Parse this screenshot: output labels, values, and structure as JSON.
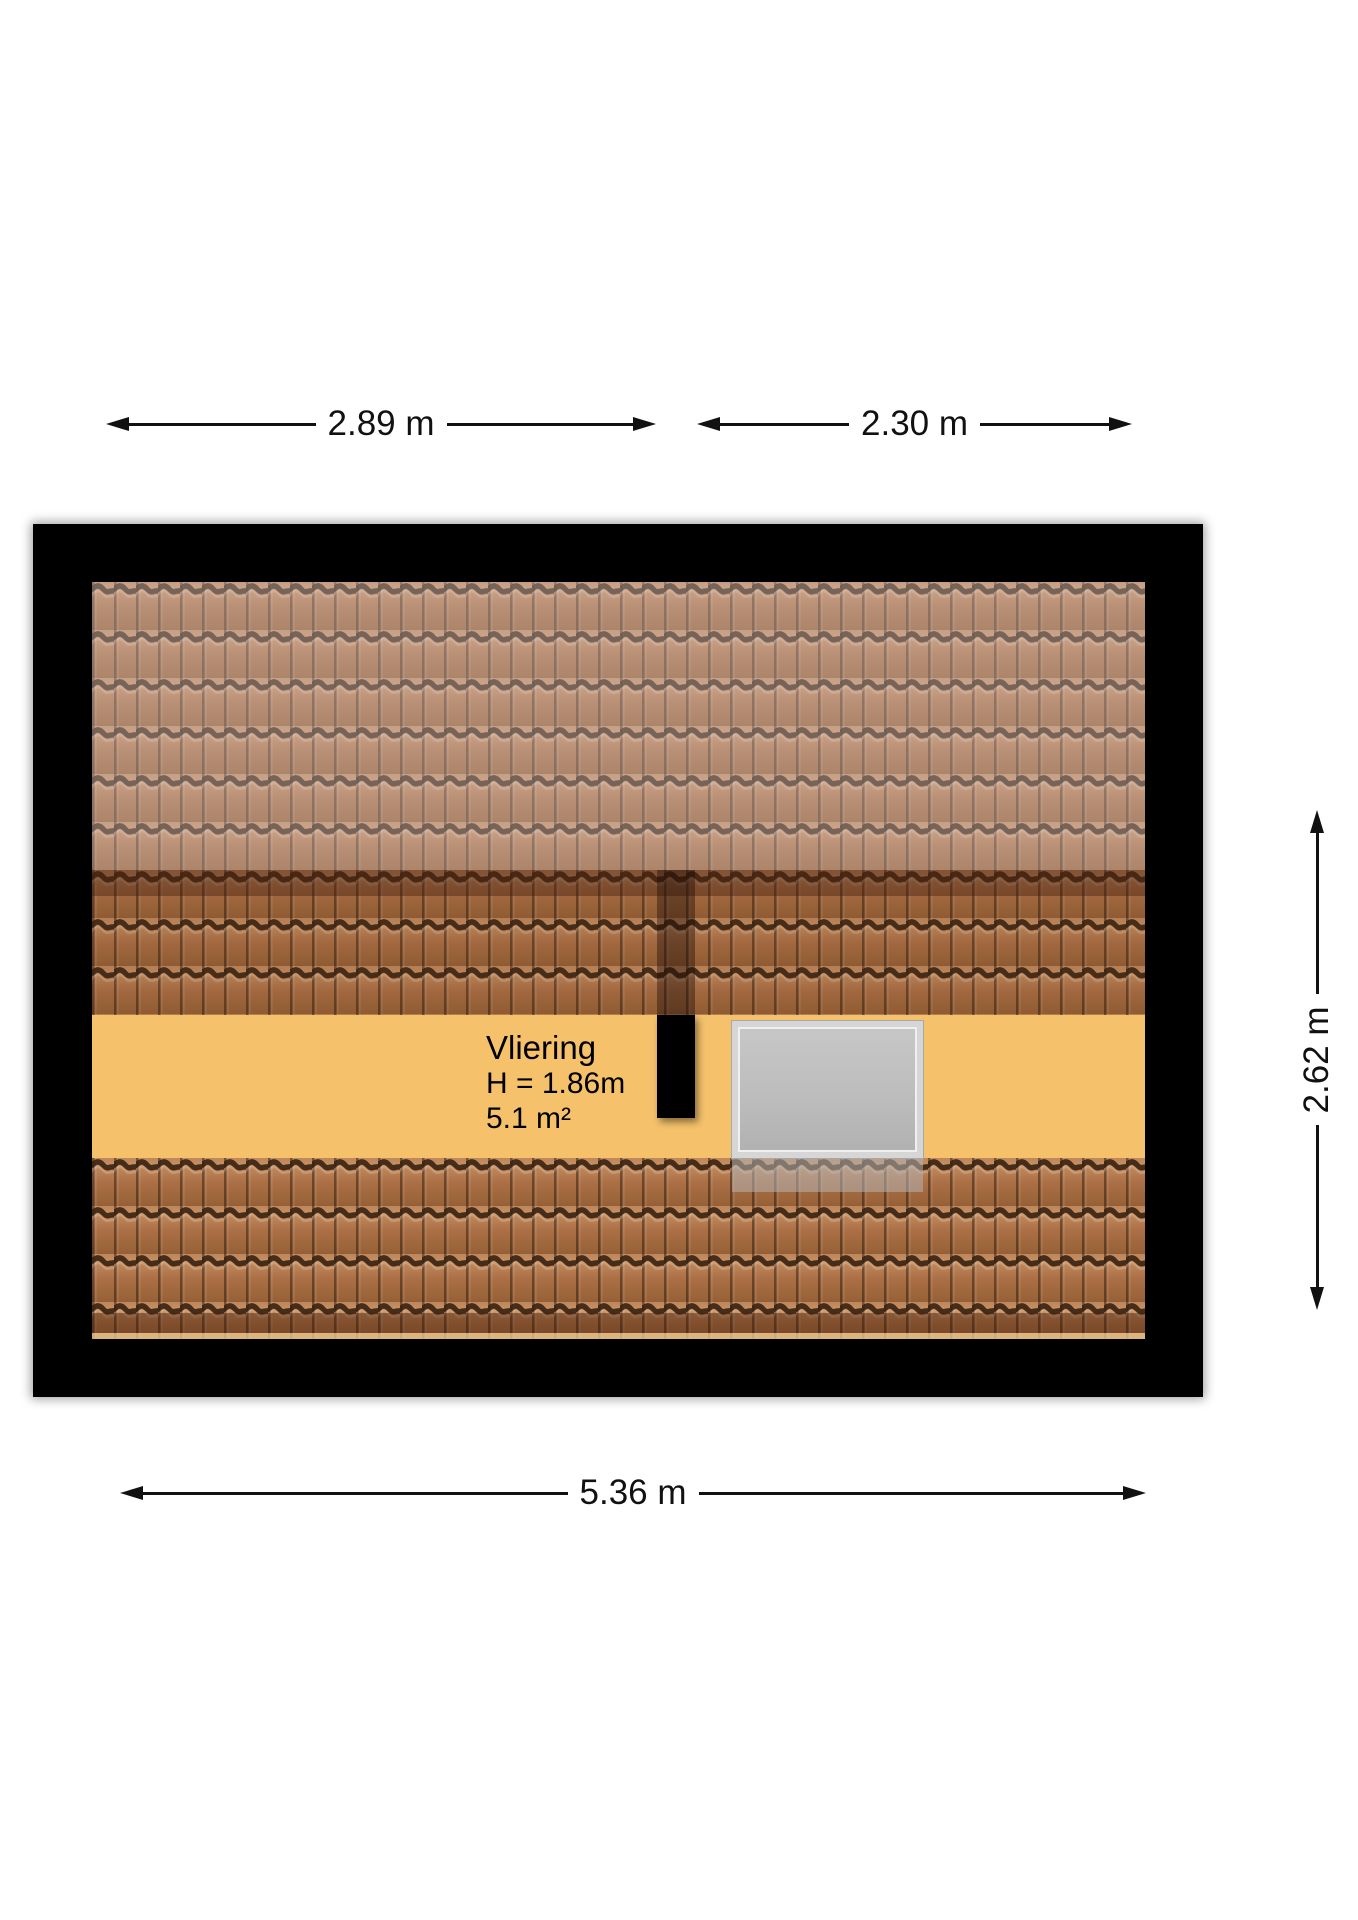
{
  "plan": {
    "type": "attic-floorplan",
    "room": {
      "name": "Vliering",
      "ceiling_height": "H = 1.86m",
      "area": "5.1 m²"
    },
    "elements": {
      "chimney": "black rectangular flue at top of floor strip",
      "skylight": "gray roof window on floor strip",
      "roof_back_slope": "grayish-brown tiled slope",
      "roof_front_slope": "orange-brown tiled slope",
      "ridge": "dark brown ridge band"
    }
  },
  "dimensions": {
    "top_left": "2.89 m",
    "top_right": "2.30 m",
    "right": "2.62 m",
    "bottom": "5.36 m"
  },
  "colors": {
    "wall": "#000000",
    "floor": "#F5C26B",
    "tile_base": "#AC6E44",
    "tile_groove": "#35200F",
    "ridge_overlay": "rgba(75,35,18,0.5)",
    "back_slope_haze": "rgba(215,205,212,0.34)",
    "skylight_frame": "#D6D6D6",
    "skylight_panel": "#BDBDBD",
    "dimension_line": "#111111",
    "background": "#FFFFFF"
  }
}
